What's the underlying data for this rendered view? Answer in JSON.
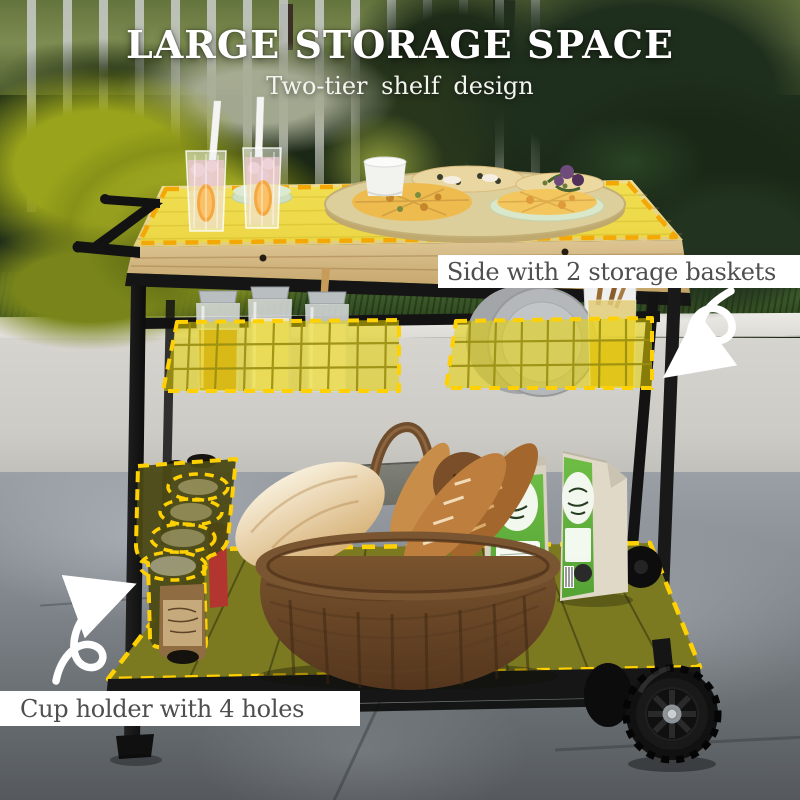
{
  "header": {
    "title": "LARGE STORAGE SPACE",
    "subtitle": "Two-tier shelf design"
  },
  "callouts": {
    "baskets": {
      "label": "Side with 2 storage baskets"
    },
    "cup_holder": {
      "label": "Cup holder with 4 holes"
    }
  },
  "colors": {
    "highlight_fill": "#f7e300",
    "dash_gold": "#ffd103",
    "dash_table": "#f3a806",
    "shelf_olive": "#7c7a20",
    "cup_holder_olive": "#4b4914",
    "callout_text": "#4f4f4f",
    "callout_bg": "#ffffff",
    "title_color": "#ffffff"
  },
  "icons": {
    "basket_arrow": "swirl-arrow-icon",
    "cup_holder_arrow": "swirl-arrow-icon"
  }
}
